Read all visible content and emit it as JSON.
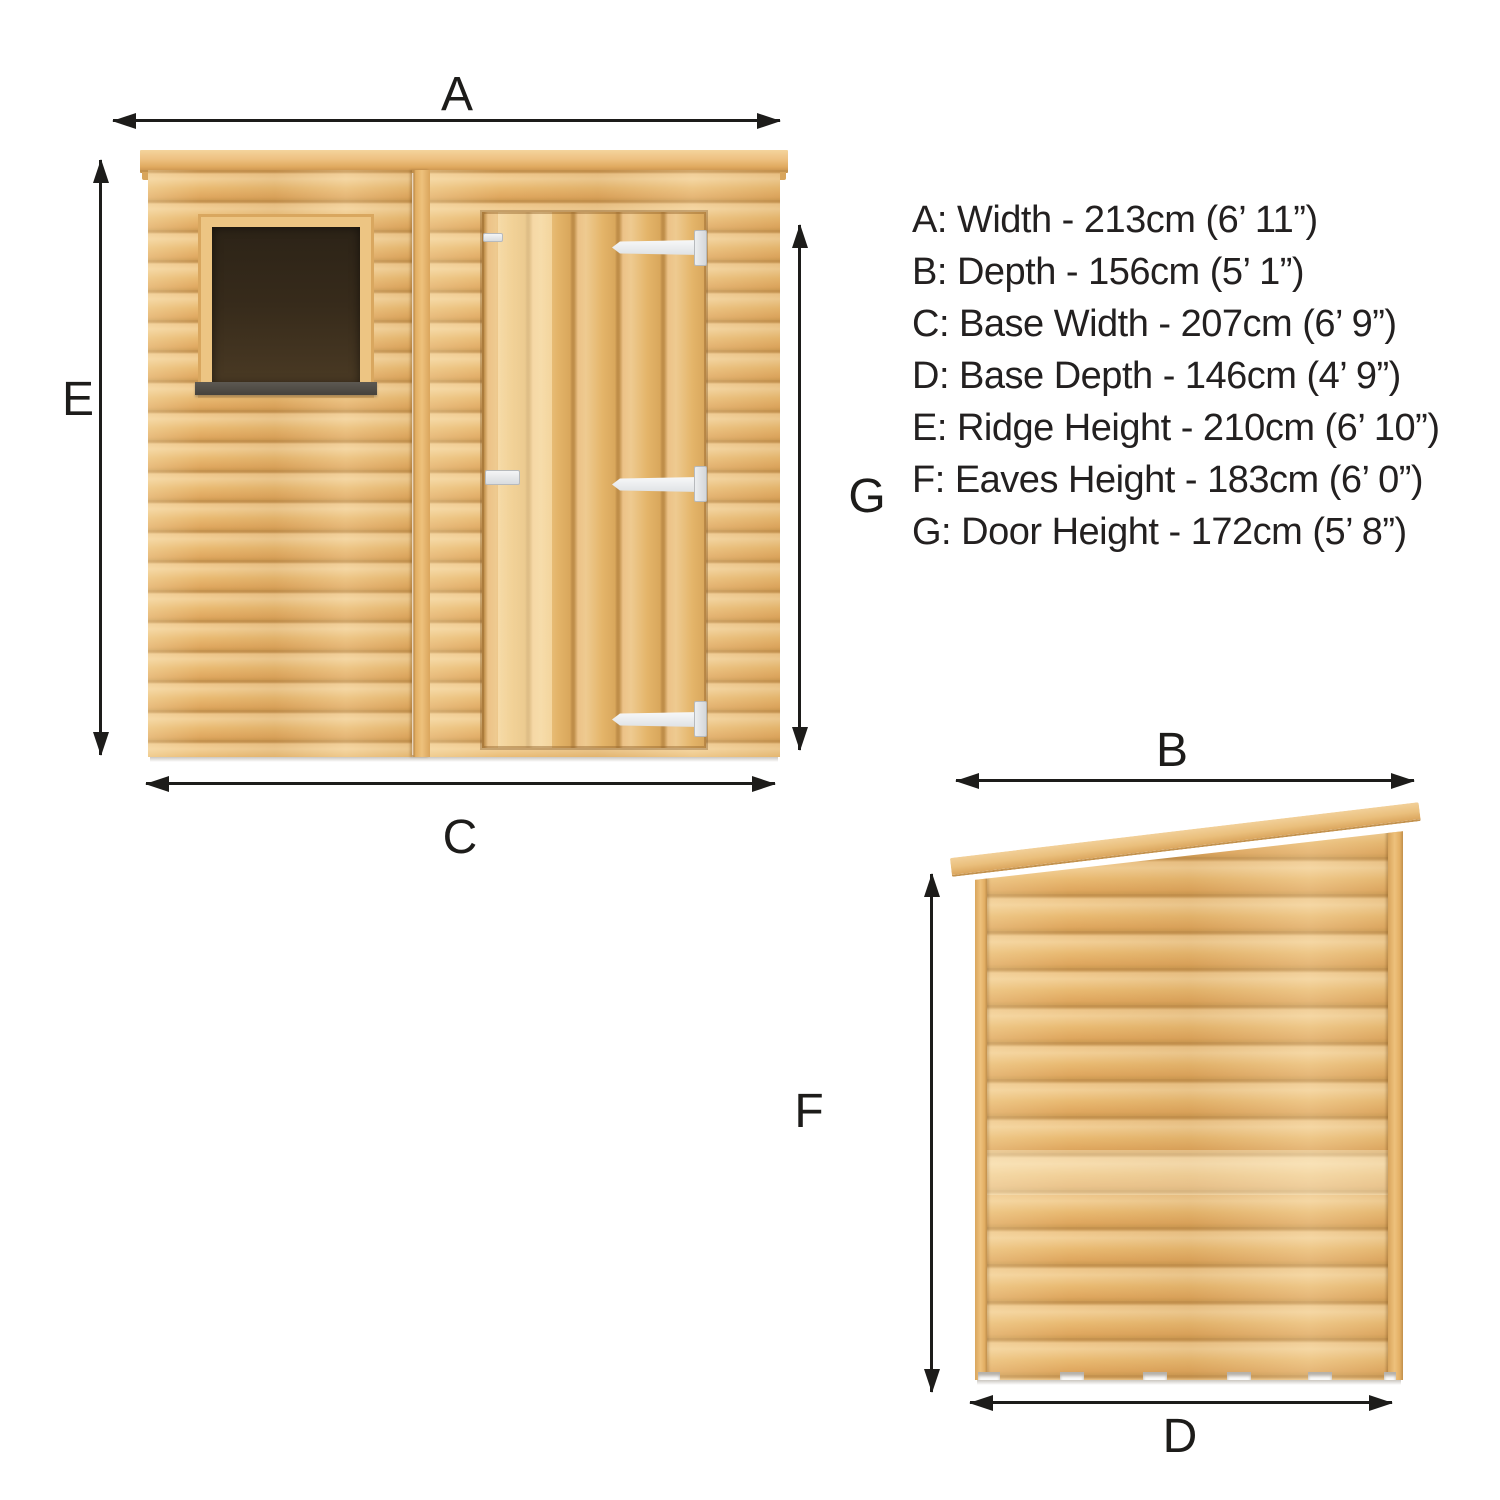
{
  "page": {
    "background": "#ffffff"
  },
  "legend": {
    "items": [
      {
        "letter": "A",
        "name": "Width",
        "cm": 213,
        "imperial": "6’ 11”",
        "label": "A: Width - 213cm (6’ 11”)"
      },
      {
        "letter": "B",
        "name": "Depth",
        "cm": 156,
        "imperial": "5’ 1”",
        "label": "B: Depth - 156cm (5’ 1”)"
      },
      {
        "letter": "C",
        "name": "Base Width",
        "cm": 207,
        "imperial": "6’ 9”",
        "label": "C: Base Width - 207cm (6’ 9”)"
      },
      {
        "letter": "D",
        "name": "Base Depth",
        "cm": 146,
        "imperial": "4’ 9”",
        "label": "D: Base Depth - 146cm (4’ 9”)"
      },
      {
        "letter": "E",
        "name": "Ridge Height",
        "cm": 210,
        "imperial": "6’ 10”",
        "label": "E: Ridge Height - 210cm (6’ 10”)"
      },
      {
        "letter": "F",
        "name": "Eaves Height",
        "cm": 183,
        "imperial": "6’ 0”",
        "label": "F: Eaves Height - 183cm (6’ 0”)"
      },
      {
        "letter": "G",
        "name": "Door Height",
        "cm": 172,
        "imperial": "5’ 8”",
        "label": "G: Door Height - 172cm (5’ 8”)"
      }
    ]
  },
  "dims": {
    "a": "A",
    "b": "B",
    "c": "C",
    "d": "D",
    "e": "E",
    "f": "F",
    "g": "G"
  },
  "colors": {
    "arrow": "#1d1c1a",
    "text": "#232020",
    "wood_highlight": "#f2cf96",
    "wood_mid": "#e9ba72",
    "wood_seam": "#c59350",
    "fascia": "#eec182",
    "window_glass": "#372b1b",
    "window_sill": "#55514b",
    "hinge": "#f1f2f4"
  },
  "views": {
    "front": {
      "name": "front elevation"
    },
    "side": {
      "name": "side elevation"
    }
  }
}
